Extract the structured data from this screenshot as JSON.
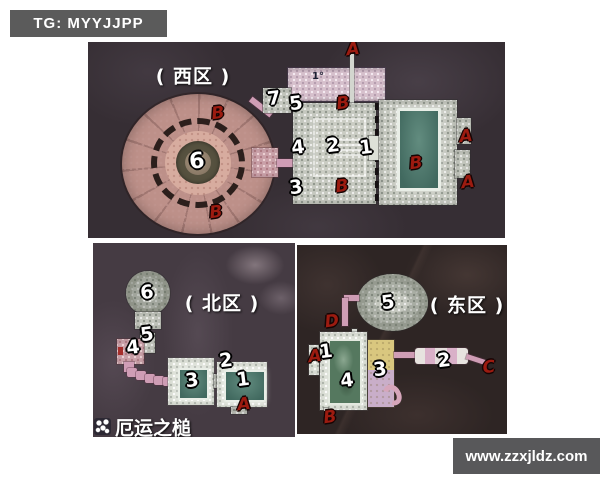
{
  "badge": {
    "label": "TG: MYYJJPP"
  },
  "watermark": {
    "label": "www.zzxjldz.com"
  },
  "legend": {
    "icon": "paw-print-icon",
    "title": "厄运之槌"
  },
  "colors": {
    "marker_number": "#ffffff",
    "marker_letter": "#9c1b10",
    "pool_teal": "#4f7a6e",
    "pool_green": "#55785f",
    "pink_corridor": "#cf9db5",
    "badge_bg": "#5b5b5b"
  },
  "zones": {
    "west": {
      "label": "( 西区 )",
      "markers": [
        {
          "t": "6",
          "type": "num",
          "x": 109,
          "y": 120,
          "s": 22
        },
        {
          "t": "7",
          "type": "num",
          "x": 186,
          "y": 57
        },
        {
          "t": "5",
          "type": "num",
          "x": 208,
          "y": 62
        },
        {
          "t": "4",
          "type": "num",
          "x": 210,
          "y": 106
        },
        {
          "t": "2",
          "type": "num",
          "x": 245,
          "y": 104
        },
        {
          "t": "1",
          "type": "num",
          "x": 278,
          "y": 106
        },
        {
          "t": "3",
          "type": "num",
          "x": 208,
          "y": 146
        },
        {
          "t": "B",
          "type": "letter",
          "x": 130,
          "y": 72
        },
        {
          "t": "B",
          "type": "letter",
          "x": 128,
          "y": 171
        },
        {
          "t": "B",
          "type": "letter",
          "x": 255,
          "y": 62
        },
        {
          "t": "B",
          "type": "letter",
          "x": 254,
          "y": 145
        },
        {
          "t": "B",
          "type": "letter",
          "x": 328,
          "y": 122
        },
        {
          "t": "A",
          "type": "letter",
          "x": 265,
          "y": 8
        },
        {
          "t": "A",
          "type": "letter",
          "x": 378,
          "y": 95
        },
        {
          "t": "A",
          "type": "letter",
          "x": 380,
          "y": 141
        },
        {
          "t": "1°",
          "type": "glyph",
          "x": 230,
          "y": 35
        }
      ]
    },
    "north": {
      "label": "( 北区 )",
      "markers": [
        {
          "t": "6",
          "type": "num",
          "x": 54,
          "y": 50
        },
        {
          "t": "5",
          "type": "num",
          "x": 54,
          "y": 92
        },
        {
          "t": "4",
          "type": "num",
          "x": 40,
          "y": 105
        },
        {
          "t": "3",
          "type": "num",
          "x": 99,
          "y": 138
        },
        {
          "t": "2",
          "type": "num",
          "x": 133,
          "y": 118
        },
        {
          "t": "1",
          "type": "num",
          "x": 150,
          "y": 137
        },
        {
          "t": "A",
          "type": "letter",
          "x": 151,
          "y": 162
        }
      ]
    },
    "east": {
      "label": "( 东区 )",
      "markers": [
        {
          "t": "5",
          "type": "num",
          "x": 91,
          "y": 58
        },
        {
          "t": "1",
          "type": "num",
          "x": 29,
          "y": 107
        },
        {
          "t": "4",
          "type": "num",
          "x": 50,
          "y": 136
        },
        {
          "t": "3",
          "type": "num",
          "x": 83,
          "y": 125
        },
        {
          "t": "2",
          "type": "num",
          "x": 147,
          "y": 116
        },
        {
          "t": "D",
          "type": "letter",
          "x": 35,
          "y": 77
        },
        {
          "t": "A",
          "type": "letter",
          "x": 18,
          "y": 112
        },
        {
          "t": "B",
          "type": "letter",
          "x": 33,
          "y": 173
        },
        {
          "t": "C",
          "type": "letter",
          "x": 192,
          "y": 123
        }
      ]
    }
  }
}
